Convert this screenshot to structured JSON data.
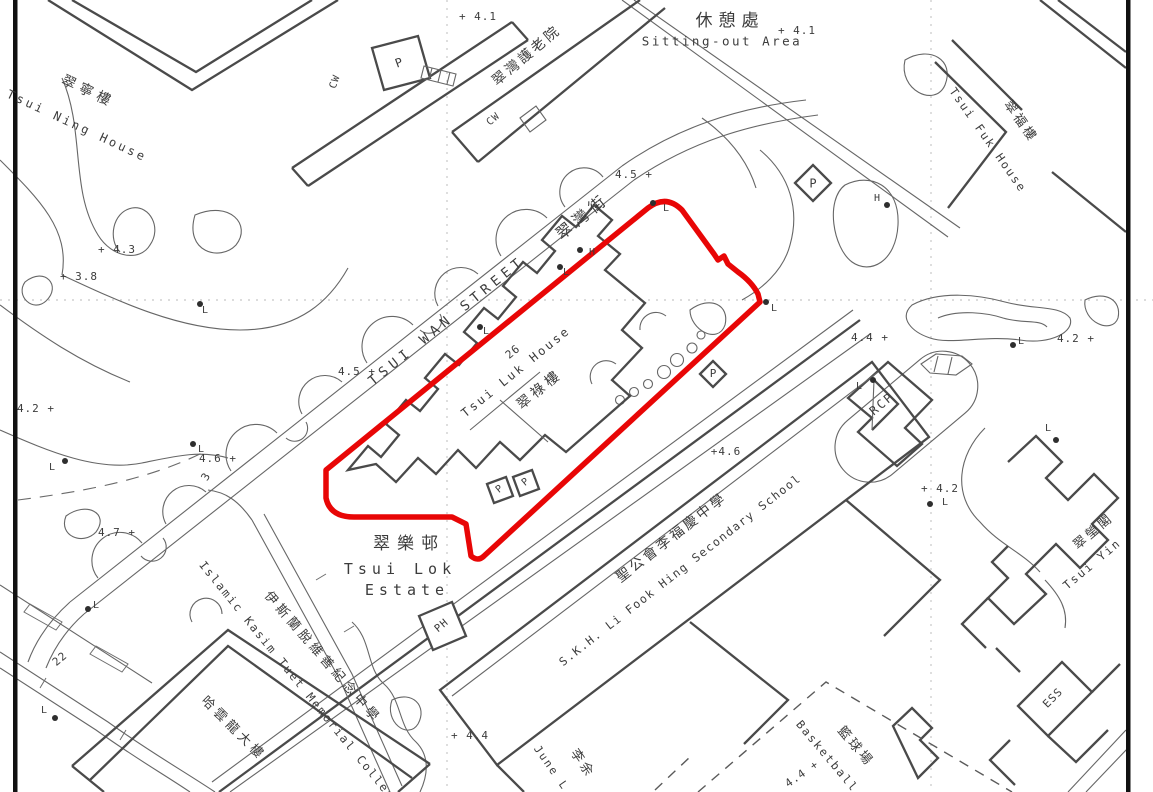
{
  "map": {
    "type": "survey-lot-plan",
    "background_color": "#ffffff",
    "boundary_color": "#e80606",
    "line_color": "#4a4a4a",
    "text_color": "#3c3c3c",
    "labels": [
      {
        "n": "label-sitting-out-area-zh",
        "t": "休憩處",
        "x": 730,
        "y": 22,
        "r": 0,
        "s": 17,
        "ls": 6
      },
      {
        "n": "label-sitting-out-area-en",
        "t": "Sitting-out Area",
        "x": 722,
        "y": 41,
        "r": 0,
        "s": 12.5,
        "ls": 2.5
      },
      {
        "n": "spot-height",
        "t": "+ 4.1",
        "x": 797,
        "y": 31,
        "r": 0,
        "s": 11,
        "ls": 1
      },
      {
        "n": "spot-height",
        "t": "+ 4.1",
        "x": 478,
        "y": 17,
        "r": 0,
        "s": 11,
        "ls": 1
      },
      {
        "n": "label-tsui-ning-house-zh",
        "t": "翠寧樓",
        "x": 88,
        "y": 92,
        "r": 25,
        "s": 14,
        "ls": 5
      },
      {
        "n": "label-tsui-ning-house-en",
        "t": "Tsui Ning House",
        "x": 77,
        "y": 126,
        "r": 25,
        "s": 12,
        "ls": 3
      },
      {
        "n": "label-care-home-zh",
        "t": "翠灣護老院",
        "x": 527,
        "y": 56,
        "r": -40,
        "s": 14,
        "ls": 3
      },
      {
        "n": "label-cw",
        "t": "CW",
        "x": 336,
        "y": 82,
        "r": -70,
        "s": 10,
        "ls": 1
      },
      {
        "n": "label-cw",
        "t": "CW",
        "x": 494,
        "y": 120,
        "r": -40,
        "s": 10,
        "ls": 1
      },
      {
        "n": "label-parking-structure",
        "t": "P",
        "x": 399,
        "y": 63,
        "r": -20,
        "s": 12,
        "ls": 0
      },
      {
        "n": "label-tsui-fuk-house-zh",
        "t": "翠福樓",
        "x": 1020,
        "y": 122,
        "r": 55,
        "s": 13,
        "ls": 3
      },
      {
        "n": "label-tsui-fuk-house-en",
        "t": "Tsui Fuk House",
        "x": 988,
        "y": 140,
        "r": 55,
        "s": 11.5,
        "ls": 2
      },
      {
        "n": "label-tsui-wan-street-en",
        "t": "TSUI WAN STREET",
        "x": 447,
        "y": 321,
        "r": -39,
        "s": 13.5,
        "ls": 5
      },
      {
        "n": "label-tsui-wan-street-zh",
        "t": "翠灣街",
        "x": 583,
        "y": 217,
        "r": -39,
        "s": 16,
        "ls": 5
      },
      {
        "n": "spot-height",
        "t": "4.5 +",
        "x": 634,
        "y": 175,
        "r": 0,
        "s": 11,
        "ls": 1
      },
      {
        "n": "spot-height",
        "t": "4.5 +",
        "x": 357,
        "y": 372,
        "r": 0,
        "s": 11,
        "ls": 1
      },
      {
        "n": "label-hydrant",
        "t": "H",
        "x": 592,
        "y": 253,
        "r": 0,
        "s": 10,
        "ls": 0
      },
      {
        "n": "label-hydrant",
        "t": "H",
        "x": 877,
        "y": 199,
        "r": 0,
        "s": 10,
        "ls": 0
      },
      {
        "n": "label-lamp",
        "t": "L",
        "x": 666,
        "y": 209,
        "r": 0,
        "s": 10,
        "ls": 0
      },
      {
        "n": "label-lamp",
        "t": "L",
        "x": 566,
        "y": 273,
        "r": 0,
        "s": 10,
        "ls": 0
      },
      {
        "n": "label-lamp",
        "t": "L",
        "x": 486,
        "y": 332,
        "r": 0,
        "s": 10,
        "ls": 0
      },
      {
        "n": "label-lamp",
        "t": "L",
        "x": 774,
        "y": 309,
        "r": 0,
        "s": 10,
        "ls": 0
      },
      {
        "n": "label-lamp",
        "t": "L",
        "x": 859,
        "y": 387,
        "r": 0,
        "s": 10,
        "ls": 0
      },
      {
        "n": "label-lamp",
        "t": "L",
        "x": 1021,
        "y": 342,
        "r": 0,
        "s": 10,
        "ls": 0
      },
      {
        "n": "label-lamp",
        "t": "L",
        "x": 1048,
        "y": 429,
        "r": 0,
        "s": 10,
        "ls": 0
      },
      {
        "n": "label-lamp",
        "t": "L",
        "x": 945,
        "y": 503,
        "r": 0,
        "s": 10,
        "ls": 0
      },
      {
        "n": "label-lamp",
        "t": "L",
        "x": 96,
        "y": 606,
        "r": 0,
        "s": 10,
        "ls": 0
      },
      {
        "n": "label-lamp",
        "t": "L",
        "x": 44,
        "y": 711,
        "r": 0,
        "s": 10,
        "ls": 0
      },
      {
        "n": "label-lamp",
        "t": "L",
        "x": 52,
        "y": 468,
        "r": 0,
        "s": 10,
        "ls": 0
      },
      {
        "n": "label-lamp",
        "t": "L",
        "x": 201,
        "y": 450,
        "r": 0,
        "s": 10,
        "ls": 0
      },
      {
        "n": "label-lamp",
        "t": "L",
        "x": 205,
        "y": 311,
        "r": 0,
        "s": 10,
        "ls": 0
      },
      {
        "n": "spot-height",
        "t": "+ 4.3",
        "x": 117,
        "y": 250,
        "r": 0,
        "s": 11,
        "ls": 1
      },
      {
        "n": "spot-height",
        "t": "+ 3.8",
        "x": 79,
        "y": 277,
        "r": 0,
        "s": 11,
        "ls": 1
      },
      {
        "n": "spot-height",
        "t": "4.2 +",
        "x": 36,
        "y": 409,
        "r": 0,
        "s": 11,
        "ls": 1
      },
      {
        "n": "spot-height",
        "t": "4.6 +",
        "x": 218,
        "y": 459,
        "r": 0,
        "s": 11,
        "ls": 1
      },
      {
        "n": "label-number-3",
        "t": "3",
        "x": 206,
        "y": 477,
        "r": -60,
        "s": 11,
        "ls": 0
      },
      {
        "n": "spot-height",
        "t": "4.7 +",
        "x": 117,
        "y": 533,
        "r": 0,
        "s": 11,
        "ls": 1
      },
      {
        "n": "label-building-number-26",
        "t": "26",
        "x": 513,
        "y": 352,
        "r": -39,
        "s": 11,
        "ls": 1
      },
      {
        "n": "label-tsui-luk-house-en",
        "t": "Tsui Luk House",
        "x": 516,
        "y": 372,
        "r": -39,
        "s": 12,
        "ls": 2.5
      },
      {
        "n": "label-tsui-luk-house-zh",
        "t": "翠祿樓",
        "x": 540,
        "y": 390,
        "r": -39,
        "s": 14,
        "ls": 4
      },
      {
        "n": "label-parking",
        "t": "P",
        "x": 713,
        "y": 374,
        "r": 0,
        "s": 11,
        "ls": 0
      },
      {
        "n": "label-parking",
        "t": "P",
        "x": 500,
        "y": 490,
        "r": -40,
        "s": 10,
        "ls": 0
      },
      {
        "n": "label-parking",
        "t": "P",
        "x": 526,
        "y": 483,
        "r": -40,
        "s": 10,
        "ls": 0
      },
      {
        "n": "label-parking",
        "t": "P",
        "x": 813,
        "y": 184,
        "r": 0,
        "s": 12,
        "ls": 0
      },
      {
        "n": "spot-height",
        "t": "+4.6",
        "x": 726,
        "y": 452,
        "r": 0,
        "s": 11,
        "ls": 1
      },
      {
        "n": "label-tsui-lok-estate-zh",
        "t": "翠樂邨",
        "x": 409,
        "y": 545,
        "r": 0,
        "s": 17,
        "ls": 7
      },
      {
        "n": "label-tsui-lok-estate-en1",
        "t": "Tsui Lok",
        "x": 400,
        "y": 570,
        "r": 0,
        "s": 15,
        "ls": 5
      },
      {
        "n": "label-tsui-lok-estate-en2",
        "t": "Estate",
        "x": 407,
        "y": 591,
        "r": 0,
        "s": 15,
        "ls": 5
      },
      {
        "n": "label-ph",
        "t": "PH",
        "x": 442,
        "y": 626,
        "r": -40,
        "s": 10.5,
        "ls": 1
      },
      {
        "n": "label-skh-school-zh",
        "t": "聖公會李福慶中學",
        "x": 672,
        "y": 538,
        "r": -38,
        "s": 14,
        "ls": 3
      },
      {
        "n": "label-skh-school-en",
        "t": "S.K.H. Li Fook Hing Secondary School",
        "x": 680,
        "y": 570,
        "r": -38,
        "s": 11.5,
        "ls": 1.5
      },
      {
        "n": "label-islamic-college-zh",
        "t": "伊斯蘭脫維善紀念中學",
        "x": 322,
        "y": 658,
        "r": 49,
        "s": 13,
        "ls": 4
      },
      {
        "n": "label-islamic-college-en",
        "t": "Islamic Kasim Tuet Memorial College",
        "x": 300,
        "y": 684,
        "r": 51,
        "s": 11.5,
        "ls": 2
      },
      {
        "n": "label-college-building-zh",
        "t": "哈雲龍大樓",
        "x": 233,
        "y": 729,
        "r": 45,
        "s": 13,
        "ls": 4
      },
      {
        "n": "spot-height",
        "t": "+ 4.4",
        "x": 470,
        "y": 736,
        "r": 0,
        "s": 11,
        "ls": 1
      },
      {
        "n": "label-june-building-en",
        "t": "June L",
        "x": 551,
        "y": 768,
        "r": 55,
        "s": 11,
        "ls": 2
      },
      {
        "n": "label-june-building-zh",
        "t": "李余",
        "x": 582,
        "y": 764,
        "r": 55,
        "s": 13,
        "ls": 3
      },
      {
        "n": "label-basketball-zh",
        "t": "籃球場",
        "x": 855,
        "y": 747,
        "r": 50,
        "s": 13,
        "ls": 3
      },
      {
        "n": "label-basketball-en",
        "t": "Basketball C",
        "x": 833,
        "y": 763,
        "r": 50,
        "s": 11.5,
        "ls": 2
      },
      {
        "n": "spot-height",
        "t": "4.4 +",
        "x": 802,
        "y": 774,
        "r": -35,
        "s": 11,
        "ls": 1
      },
      {
        "n": "label-rcp",
        "t": "RCP",
        "x": 882,
        "y": 404,
        "r": -40,
        "s": 12,
        "ls": 2
      },
      {
        "n": "spot-height",
        "t": "4.4 +",
        "x": 870,
        "y": 338,
        "r": 0,
        "s": 11,
        "ls": 1
      },
      {
        "n": "spot-height",
        "t": "4.2 +",
        "x": 1076,
        "y": 339,
        "r": 0,
        "s": 11,
        "ls": 1
      },
      {
        "n": "spot-height",
        "t": "+ 4.2",
        "x": 940,
        "y": 489,
        "r": 0,
        "s": 11,
        "ls": 1
      },
      {
        "n": "label-tsui-ying-court-zh",
        "t": "翠瑩閣",
        "x": 1094,
        "y": 532,
        "r": -40,
        "s": 13,
        "ls": 3
      },
      {
        "n": "label-tsui-ying-court-en",
        "t": "Tsui Yin",
        "x": 1092,
        "y": 564,
        "r": -40,
        "s": 11.5,
        "ls": 2
      },
      {
        "n": "label-ess",
        "t": "ESS",
        "x": 1053,
        "y": 698,
        "r": -45,
        "s": 11,
        "ls": 1
      },
      {
        "n": "label-number-22",
        "t": "22",
        "x": 60,
        "y": 659,
        "r": -40,
        "s": 11,
        "ls": 1
      }
    ],
    "utility_dots": [
      [
        653,
        203
      ],
      [
        560,
        267
      ],
      [
        580,
        250
      ],
      [
        480,
        327
      ],
      [
        766,
        302
      ],
      [
        873,
        380
      ],
      [
        1013,
        345
      ],
      [
        1056,
        440
      ],
      [
        930,
        504
      ],
      [
        88,
        609
      ],
      [
        55,
        718
      ],
      [
        65,
        461
      ],
      [
        193,
        444
      ],
      [
        200,
        304
      ],
      [
        887,
        205
      ]
    ]
  }
}
